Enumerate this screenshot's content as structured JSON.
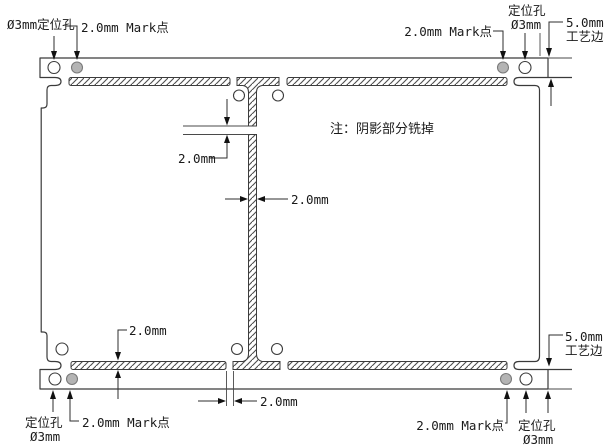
{
  "drawing": {
    "note": "注：阴影部分铣掉",
    "labels": {
      "top_left_hole": "Ø3mm定位孔",
      "top_left_mark": "2.0mm Mark点",
      "top_right_mark": "2.0mm Mark点",
      "top_right_hole_line1": "定位孔",
      "top_right_hole_line2": "Ø3mm",
      "top_right_edge_line1": "5.0mm",
      "top_right_edge_line2": "工艺边",
      "bottom_left_hole_line1": "定位孔",
      "bottom_left_hole_line2": "Ø3mm",
      "bottom_left_mark": "2.0mm Mark点",
      "bottom_right_mark": "2.0mm Mark点",
      "bottom_right_hole_line1": "定位孔",
      "bottom_right_hole_line2": "Ø3mm",
      "bottom_right_edge_line1": "5.0mm",
      "bottom_right_edge_line2": "工艺边"
    },
    "dimensions": {
      "rout_gap_vertical": "2.0mm",
      "channel_width": "2.0mm",
      "strip_thickness": "2.0mm",
      "bottom_tab_gap": "2.0mm"
    },
    "colors": {
      "line": "#3a3a3a",
      "hatch": "#4d4d4d",
      "mark_point_fill": "#b4b4b4",
      "note_text": "#9c9c9c"
    }
  }
}
